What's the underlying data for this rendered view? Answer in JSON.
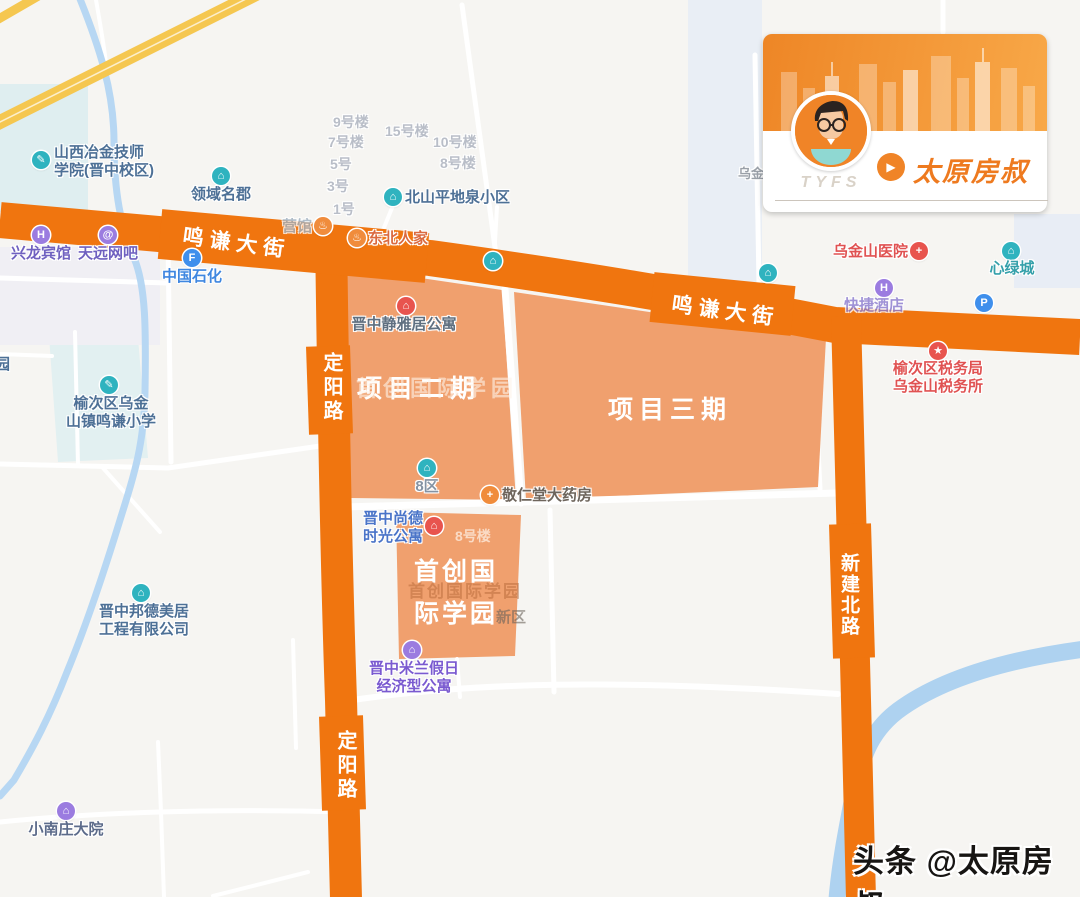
{
  "footer": {
    "text": "头条 @太原房叔"
  },
  "card": {
    "tyfs": "TYFS",
    "brand": "太原房叔",
    "play_glyph": "▶",
    "accent": "#ee7a1f"
  },
  "roads": {
    "mingqian": "鸣谦大街",
    "dingyang": "定阳路",
    "xinjianbei": "新建北路"
  },
  "projects": {
    "phase2": "项目二期",
    "phase3": "项目三期",
    "campus": [
      "首创国",
      "际学园"
    ]
  },
  "colors": {
    "road_orange": "#f0750f",
    "polygon_orange": "#f0a06e",
    "highway_yellow": "#f5c750",
    "river_blue": "#aed2f0",
    "poi_teal": "#2fb3bf",
    "poi_purple": "#9b7ce0",
    "poi_blue": "#3f8fec",
    "poi_red": "#e8544e",
    "poi_orange": "#f08c3c"
  },
  "pois": [
    {
      "id": "poi-shanxi-metallurgy-college",
      "label": [
        "山西冶金技师",
        "学院(晋中校区)"
      ],
      "x": 41,
      "y": 160,
      "icon": {
        "color": "#2fb3bf",
        "glyph": "✎"
      },
      "text": {
        "color": "#4d7096",
        "align": "left",
        "dx": 13,
        "dy": -16
      }
    },
    {
      "id": "poi-lingyu-mingjun",
      "label": [
        "领域名郡"
      ],
      "x": 221,
      "y": 176,
      "icon": {
        "color": "#2fb3bf",
        "glyph": "⌂"
      },
      "text": {
        "color": "#4d7096",
        "align": "center",
        "dx": 0,
        "dy": 10
      }
    },
    {
      "id": "poi-beishan-pingdiquan",
      "label": [
        "北山平地泉小区"
      ],
      "x": 393,
      "y": 197,
      "icon": {
        "color": "#2fb3bf",
        "glyph": "⌂"
      },
      "text": {
        "color": "#4d7096",
        "align": "left",
        "dx": 12,
        "dy": -8
      }
    },
    {
      "id": "poi-dongbei-renjia",
      "label": [
        "东北人家"
      ],
      "x": 357,
      "y": 238,
      "icon": {
        "color": "#f08c3c",
        "glyph": "♨"
      },
      "text": {
        "color": "#db6a40",
        "align": "left",
        "dx": 11,
        "dy": -8
      }
    },
    {
      "id": "poi-guan-partial",
      "label": [
        "营馆"
      ],
      "x": 323,
      "y": 226,
      "icon": {
        "color": "#f08c3c",
        "glyph": "♨"
      },
      "text": {
        "color": "#9fb0c0",
        "align": "right",
        "dx": -11,
        "dy": -8,
        "opacity": 0.8
      }
    },
    {
      "id": "poi-xinglong-hotel",
      "label": [
        "兴龙宾馆"
      ],
      "x": 41,
      "y": 235,
      "icon": {
        "color": "#9b7ce0",
        "glyph": "H"
      },
      "text": {
        "color": "#6f61c0",
        "align": "center",
        "dx": 0,
        "dy": 10
      }
    },
    {
      "id": "poi-tianyuan-netbar",
      "label": [
        "天远网吧"
      ],
      "x": 108,
      "y": 235,
      "icon": {
        "color": "#9b7ce0",
        "glyph": "@"
      },
      "text": {
        "color": "#6f61c0",
        "align": "center",
        "dx": 0,
        "dy": 10
      }
    },
    {
      "id": "poi-sinopec",
      "label": [
        "中国石化"
      ],
      "x": 192,
      "y": 258,
      "icon": {
        "color": "#3f8fec",
        "glyph": "F"
      },
      "text": {
        "color": "#3f87e0",
        "align": "center",
        "dx": 0,
        "dy": 10
      }
    },
    {
      "id": "poi-mingqian-primary-school",
      "label": [
        "榆次区乌金",
        "山镇鸣谦小学"
      ],
      "x": 109,
      "y": 385,
      "icon": {
        "color": "#2fb3bf",
        "glyph": "✎"
      },
      "text": {
        "color": "#4d7096",
        "align": "center",
        "dx": 2,
        "dy": 10
      }
    },
    {
      "id": "poi-jingyaju-apartment",
      "label": [
        "晋中静雅居公寓"
      ],
      "x": 406,
      "y": 306,
      "icon": {
        "color": "#e8544e",
        "glyph": "⌂"
      },
      "text": {
        "color": "#5f6f80",
        "align": "center",
        "dx": -2,
        "dy": 10
      }
    },
    {
      "id": "poi-8-district",
      "label": [
        "8区"
      ],
      "x": 427,
      "y": 468,
      "icon": {
        "color": "#2fb3bf",
        "glyph": "⌂"
      },
      "text": {
        "color": "#8593a3",
        "align": "center",
        "dx": 0,
        "dy": 10
      }
    },
    {
      "id": "poi-jingrentang-pharmacy",
      "label": [
        "敬仁堂大药房"
      ],
      "x": 490,
      "y": 495,
      "icon": {
        "color": "#f08c3c",
        "glyph": "+"
      },
      "text": {
        "color": "#6e655c",
        "align": "left",
        "dx": 12,
        "dy": -8
      }
    },
    {
      "id": "poi-shangde-time-apartment",
      "label": [
        "晋中尚德",
        "时光公寓"
      ],
      "x": 434,
      "y": 526,
      "icon": {
        "color": "#e8544e",
        "glyph": "⌂"
      },
      "text": {
        "color": "#4a74c8",
        "align": "right",
        "dx": -11,
        "dy": -16
      }
    },
    {
      "id": "poi-milan-holiday-apartment",
      "label": [
        "晋中米兰假日",
        "经济型公寓"
      ],
      "x": 412,
      "y": 650,
      "icon": {
        "color": "#9b7ce0",
        "glyph": "⌂"
      },
      "text": {
        "color": "#7a5ad0",
        "align": "center",
        "dx": 2,
        "dy": 10
      }
    },
    {
      "id": "poi-bangde-meiju-company",
      "label": [
        "晋中邦德美居",
        "工程有限公司"
      ],
      "x": 141,
      "y": 593,
      "icon": {
        "color": "#2fb3bf",
        "glyph": "⌂"
      },
      "text": {
        "color": "#4d7096",
        "align": "center",
        "dx": 3,
        "dy": 10
      }
    },
    {
      "id": "poi-xiaonanzhuang-dayuan",
      "label": [
        "小南庄大院"
      ],
      "x": 66,
      "y": 811,
      "icon": {
        "color": "#9b7ce0",
        "glyph": "⌂"
      },
      "text": {
        "color": "#5c6b8a",
        "align": "center",
        "dx": 0,
        "dy": 10
      }
    },
    {
      "id": "poi-wujinshan-hospital",
      "label": [
        "乌金山医院"
      ],
      "x": 919,
      "y": 251,
      "icon": {
        "color": "#e8544e",
        "glyph": "+"
      },
      "text": {
        "color": "#e05252",
        "align": "right",
        "dx": -11,
        "dy": -8
      }
    },
    {
      "id": "poi-xinlvcheng",
      "label": [
        "心绿城"
      ],
      "x": 1011,
      "y": 251,
      "icon": {
        "color": "#2fb3bf",
        "glyph": "⌂"
      },
      "text": {
        "color": "#35a0aa",
        "align": "center",
        "dx": 1,
        "dy": 9
      }
    },
    {
      "id": "poi-express-hotel",
      "label": [
        "快捷酒店"
      ],
      "x": 884,
      "y": 288,
      "icon": {
        "color": "#9b7ce0",
        "glyph": "H"
      },
      "text": {
        "color": "#8a7ad0",
        "align": "center",
        "dx": -10,
        "dy": 9,
        "opacity": 0.8
      }
    },
    {
      "id": "poi-parking",
      "label": [],
      "x": 984,
      "y": 303,
      "icon": {
        "color": "#3f8fec",
        "glyph": "P"
      },
      "text": {
        "color": "#3f8fec",
        "align": "center",
        "dx": 0,
        "dy": 9
      }
    },
    {
      "id": "poi-tax-office",
      "label": [
        "榆次区税务局",
        "乌金山税务所"
      ],
      "x": 938,
      "y": 351,
      "icon": {
        "color": "#e8544e",
        "glyph": "★"
      },
      "text": {
        "color": "#e05252",
        "align": "center",
        "dx": 0,
        "dy": 9
      }
    },
    {
      "id": "poi-unnamed-teal-1",
      "label": [],
      "x": 768,
      "y": 273,
      "icon": {
        "color": "#2fb3bf",
        "glyph": "⌂"
      },
      "text": {
        "color": "#4d7096",
        "align": "center",
        "dx": 0,
        "dy": 9
      }
    },
    {
      "id": "poi-unnamed-teal-2",
      "label": [],
      "x": 493,
      "y": 261,
      "icon": {
        "color": "#2fb3bf",
        "glyph": "⌂"
      },
      "text": {
        "color": "#4d7096",
        "align": "center",
        "dx": 0,
        "dy": 9
      }
    }
  ],
  "flat_labels": [
    {
      "id": "bldg-9",
      "text": "9号楼",
      "x": 333,
      "y": 112,
      "size": 14,
      "color": "#b9bec8",
      "halo": true
    },
    {
      "id": "bldg-7",
      "text": "7号楼",
      "x": 328,
      "y": 132,
      "size": 14,
      "color": "#b9bec8",
      "halo": true
    },
    {
      "id": "bldg-15",
      "text": "15号楼",
      "x": 385,
      "y": 121,
      "size": 14,
      "color": "#b9bec8",
      "halo": true
    },
    {
      "id": "bldg-10",
      "text": "10号楼",
      "x": 433,
      "y": 132,
      "size": 14,
      "color": "#b9bec8",
      "halo": true
    },
    {
      "id": "bldg-5",
      "text": "5号",
      "x": 330,
      "y": 154,
      "size": 14,
      "color": "#b9bec8",
      "halo": true
    },
    {
      "id": "bldg-8",
      "text": "8号楼",
      "x": 440,
      "y": 153,
      "size": 14,
      "color": "#b9bec8",
      "halo": true
    },
    {
      "id": "bldg-3",
      "text": "3号",
      "x": 327,
      "y": 176,
      "size": 14,
      "color": "#b9bec8",
      "halo": true
    },
    {
      "id": "bldg-1",
      "text": "1号",
      "x": 333,
      "y": 199,
      "size": 14,
      "color": "#b9bec8",
      "halo": true
    },
    {
      "id": "edge-yuan",
      "text": "园",
      "x": -5,
      "y": 353,
      "size": 15,
      "color": "#4d7096",
      "halo": true
    },
    {
      "id": "edge-wujin",
      "text": "乌金",
      "x": 738,
      "y": 163,
      "size": 13,
      "color": "#9aa0a8",
      "halo": true
    },
    {
      "id": "ghost-campus-1",
      "text": "首创国际学园",
      "x": 356,
      "y": 371,
      "size": 22,
      "ls": 5,
      "color": "rgba(254,243,233,0.6)",
      "halo": false
    },
    {
      "id": "ghost-campus-2",
      "text": "首创国际学园",
      "x": 408,
      "y": 577,
      "size": 17,
      "ls": 2,
      "color": "rgba(176,98,52,0.45)",
      "halo": false
    },
    {
      "id": "ghost-xinqu",
      "text": "新区",
      "x": 496,
      "y": 606,
      "size": 15,
      "ls": 0,
      "color": "rgba(106,98,90,0.6)",
      "halo": false
    },
    {
      "id": "ghost-bldg-8",
      "text": "8号楼",
      "x": 455,
      "y": 526,
      "size": 14,
      "ls": 0,
      "color": "rgba(255,250,244,0.65)",
      "halo": false
    }
  ]
}
